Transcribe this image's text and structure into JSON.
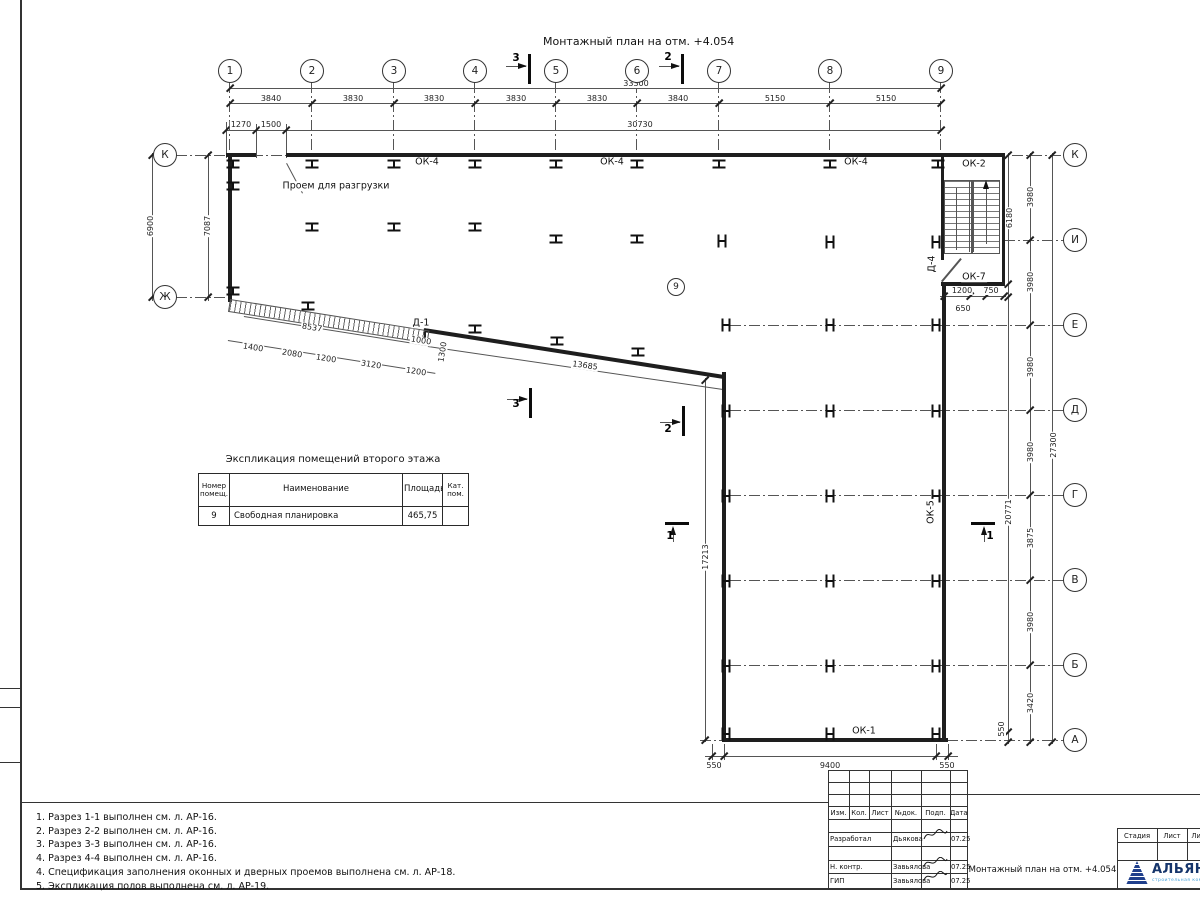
{
  "plan": {
    "title": "Монтажный план на отм. +4.054",
    "room_circle": {
      "t": "9",
      "x": 676,
      "y": 287
    },
    "axis_circles": [
      {
        "t": "1",
        "x": 230,
        "y": 71
      },
      {
        "t": "2",
        "x": 312,
        "y": 71
      },
      {
        "t": "3",
        "x": 394,
        "y": 71
      },
      {
        "t": "4",
        "x": 475,
        "y": 71
      },
      {
        "t": "5",
        "x": 556,
        "y": 71
      },
      {
        "t": "6",
        "x": 637,
        "y": 71
      },
      {
        "t": "7",
        "x": 719,
        "y": 71
      },
      {
        "t": "8",
        "x": 830,
        "y": 71
      },
      {
        "t": "9",
        "x": 941,
        "y": 71
      },
      {
        "t": "К",
        "x": 165,
        "y": 155
      },
      {
        "t": "Ж",
        "x": 165,
        "y": 297
      },
      {
        "t": "К",
        "x": 1075,
        "y": 155
      },
      {
        "t": "И",
        "x": 1075,
        "y": 240
      },
      {
        "t": "Е",
        "x": 1075,
        "y": 325
      },
      {
        "t": "Д",
        "x": 1075,
        "y": 410
      },
      {
        "t": "Г",
        "x": 1075,
        "y": 495
      },
      {
        "t": "В",
        "x": 1075,
        "y": 580
      },
      {
        "t": "Б",
        "x": 1075,
        "y": 665
      },
      {
        "t": "А",
        "x": 1075,
        "y": 740
      }
    ],
    "dim_labels": [
      {
        "t": "33300",
        "x": 636,
        "y": 84
      },
      {
        "t": "3840",
        "x": 271,
        "y": 99
      },
      {
        "t": "3830",
        "x": 353,
        "y": 99
      },
      {
        "t": "3830",
        "x": 434,
        "y": 99
      },
      {
        "t": "3830",
        "x": 516,
        "y": 99
      },
      {
        "t": "3830",
        "x": 597,
        "y": 99
      },
      {
        "t": "3840",
        "x": 678,
        "y": 99
      },
      {
        "t": "5150",
        "x": 775,
        "y": 99
      },
      {
        "t": "5150",
        "x": 886,
        "y": 99
      },
      {
        "t": "1270",
        "x": 241,
        "y": 125
      },
      {
        "t": "1500",
        "x": 271,
        "y": 125
      },
      {
        "t": "30730",
        "x": 640,
        "y": 125
      },
      {
        "t": "6900",
        "x": 151,
        "y": 226,
        "r": -90
      },
      {
        "t": "7087",
        "x": 208,
        "y": 226,
        "r": -90
      },
      {
        "t": "8537",
        "x": 312,
        "y": 328,
        "r": 9
      },
      {
        "t": "1400",
        "x": 253,
        "y": 348,
        "r": 9
      },
      {
        "t": "2080",
        "x": 292,
        "y": 354,
        "r": 9
      },
      {
        "t": "1200",
        "x": 326,
        "y": 359,
        "r": 9
      },
      {
        "t": "3120",
        "x": 371,
        "y": 365,
        "r": 9
      },
      {
        "t": "1200",
        "x": 416,
        "y": 372,
        "r": 9
      },
      {
        "t": "1000",
        "x": 421,
        "y": 341,
        "r": 9
      },
      {
        "t": "1300",
        "x": 443,
        "y": 352,
        "r": -81
      },
      {
        "t": "13685",
        "x": 585,
        "y": 366,
        "r": 8
      },
      {
        "t": "17213",
        "x": 706,
        "y": 557,
        "r": -90
      },
      {
        "t": "550",
        "x": 714,
        "y": 766
      },
      {
        "t": "9400",
        "x": 830,
        "y": 766
      },
      {
        "t": "550",
        "x": 947,
        "y": 766
      },
      {
        "t": "3980",
        "x": 1031,
        "y": 197,
        "r": -90
      },
      {
        "t": "3980",
        "x": 1031,
        "y": 282,
        "r": -90
      },
      {
        "t": "3980",
        "x": 1031,
        "y": 367,
        "r": -90
      },
      {
        "t": "3980",
        "x": 1031,
        "y": 452,
        "r": -90
      },
      {
        "t": "3875",
        "x": 1031,
        "y": 538,
        "r": -90
      },
      {
        "t": "3980",
        "x": 1031,
        "y": 622,
        "r": -90
      },
      {
        "t": "3420",
        "x": 1031,
        "y": 703,
        "r": -90
      },
      {
        "t": "27300",
        "x": 1054,
        "y": 445,
        "r": -90
      },
      {
        "t": "20771",
        "x": 1009,
        "y": 512,
        "r": -90
      },
      {
        "t": "6180",
        "x": 1010,
        "y": 218,
        "r": -90
      },
      {
        "t": "550",
        "x": 1002,
        "y": 729,
        "r": -90
      },
      {
        "t": "1200",
        "x": 962,
        "y": 291
      },
      {
        "t": "750",
        "x": 991,
        "y": 291
      },
      {
        "t": "650",
        "x": 963,
        "y": 309
      }
    ],
    "feature_labels": [
      {
        "t": "ОК-4",
        "x": 427,
        "y": 162
      },
      {
        "t": "ОК-4",
        "x": 612,
        "y": 162
      },
      {
        "t": "ОК-4",
        "x": 856,
        "y": 162
      },
      {
        "t": "ОК-2",
        "x": 974,
        "y": 164
      },
      {
        "t": "ОК-7",
        "x": 974,
        "y": 277
      },
      {
        "t": "ОК-5",
        "x": 931,
        "y": 512,
        "r": -90
      },
      {
        "t": "ОК-1",
        "x": 864,
        "y": 731
      },
      {
        "t": "Д-1",
        "x": 421,
        "y": 323
      },
      {
        "t": "Д-4",
        "x": 932,
        "y": 264,
        "r": -90
      },
      {
        "t": "Проем для разгрузки",
        "x": 336,
        "y": 186
      }
    ],
    "section_labels": [
      {
        "t": "3",
        "x": 516,
        "y": 58
      },
      {
        "t": "2",
        "x": 668,
        "y": 57
      },
      {
        "t": "3",
        "x": 516,
        "y": 404
      },
      {
        "t": "2",
        "x": 668,
        "y": 429
      },
      {
        "t": "1",
        "x": 670,
        "y": 536
      },
      {
        "t": "1",
        "x": 990,
        "y": 536
      }
    ]
  },
  "explication": {
    "title": "Экспликация помещений второго этажа",
    "headers": [
      "Номер помещ.",
      "Наименование",
      "Площадь",
      "Кат. пом."
    ],
    "rows": [
      {
        "num": "9",
        "name": "Свободная планировка",
        "area": "465,75",
        "cat": ""
      }
    ]
  },
  "notes": [
    "1. Разрез 1-1 выполнен см. л. АР-16.",
    "2. Разрез 2-2 выполнен см. л. АР-16.",
    "3. Разрез 3-3 выполнен см. л. АР-16.",
    "4. Разрез 4-4 выполнен см. л. АР-16.",
    "4. Спецификация заполнения оконных и дверных проемов выполнена см. л. АР-18.",
    "5. Экспликация полов выполнена см. л. АР-19."
  ],
  "titleblock": {
    "cols": [
      "Изм.",
      "Кол.",
      "Лист",
      "№док.",
      "Подп.",
      "Дата"
    ],
    "rows": [
      {
        "role": "Разработал",
        "name": "Дьякова",
        "date": "07.25"
      },
      {
        "role": "Н. контр.",
        "name": "Завьялова",
        "date": "07.25"
      },
      {
        "role": "ГИП",
        "name": "Завьялова",
        "date": "07.25"
      }
    ],
    "doc_title": "Монтажный план на отм. +4.054",
    "stage_cols": [
      "Стадия",
      "Лист",
      "Лист"
    ],
    "logo": {
      "name": "АЛЬЯНС",
      "tagline": "строительная компания",
      "navy": "#16356b",
      "blue": "#4aa3da"
    }
  }
}
